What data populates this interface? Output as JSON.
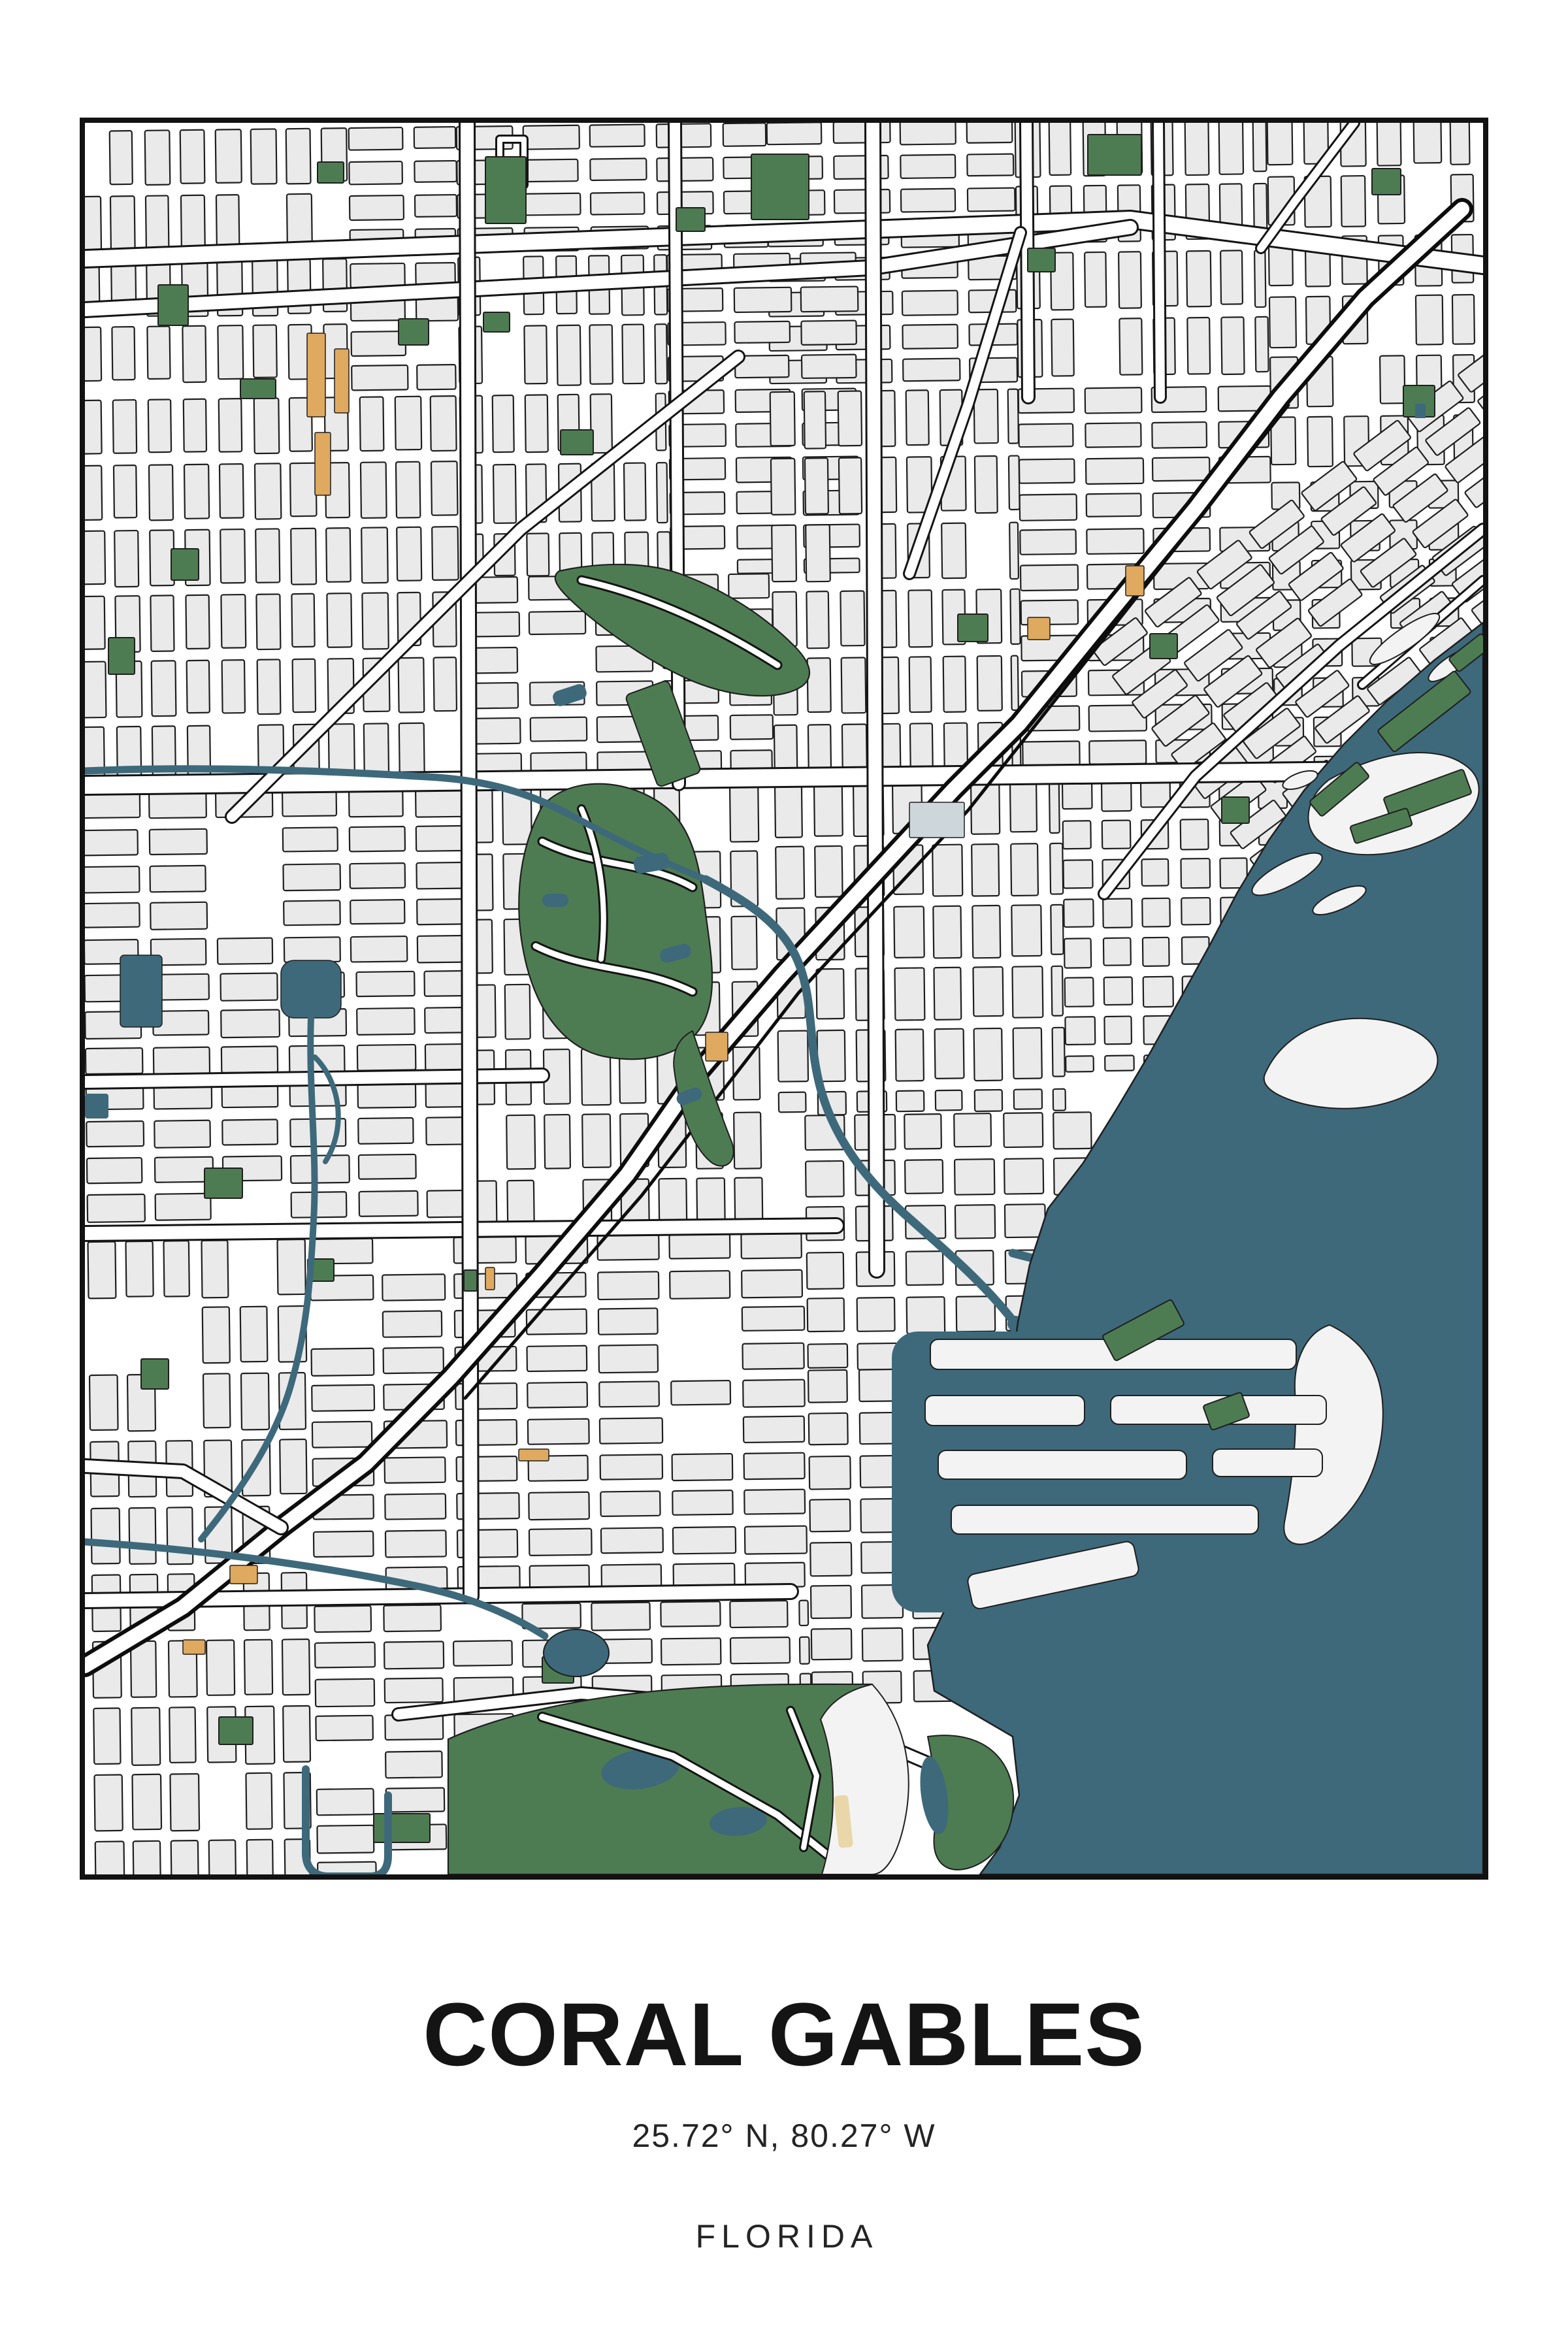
{
  "poster": {
    "title": "CORAL GABLES",
    "coordinates": "25.72° N, 80.27° W",
    "state": "FLORIDA"
  },
  "map": {
    "colors": {
      "background": "#ffffff",
      "block_fill": "#eaeaea",
      "block_outline": "#1f1f1f",
      "street": "#ffffff",
      "road_casing": "#141414",
      "highway_casing": "#0d0d0d",
      "water": "#3d697b",
      "park": "#4e7c52",
      "building_accent": "#dfa95f",
      "sand": "#e9d6a9",
      "island": "#f3f3f3",
      "campus": "#ccd6db",
      "frame": "#121212",
      "title_text": "#141414",
      "subtitle_text": "#242424"
    }
  }
}
